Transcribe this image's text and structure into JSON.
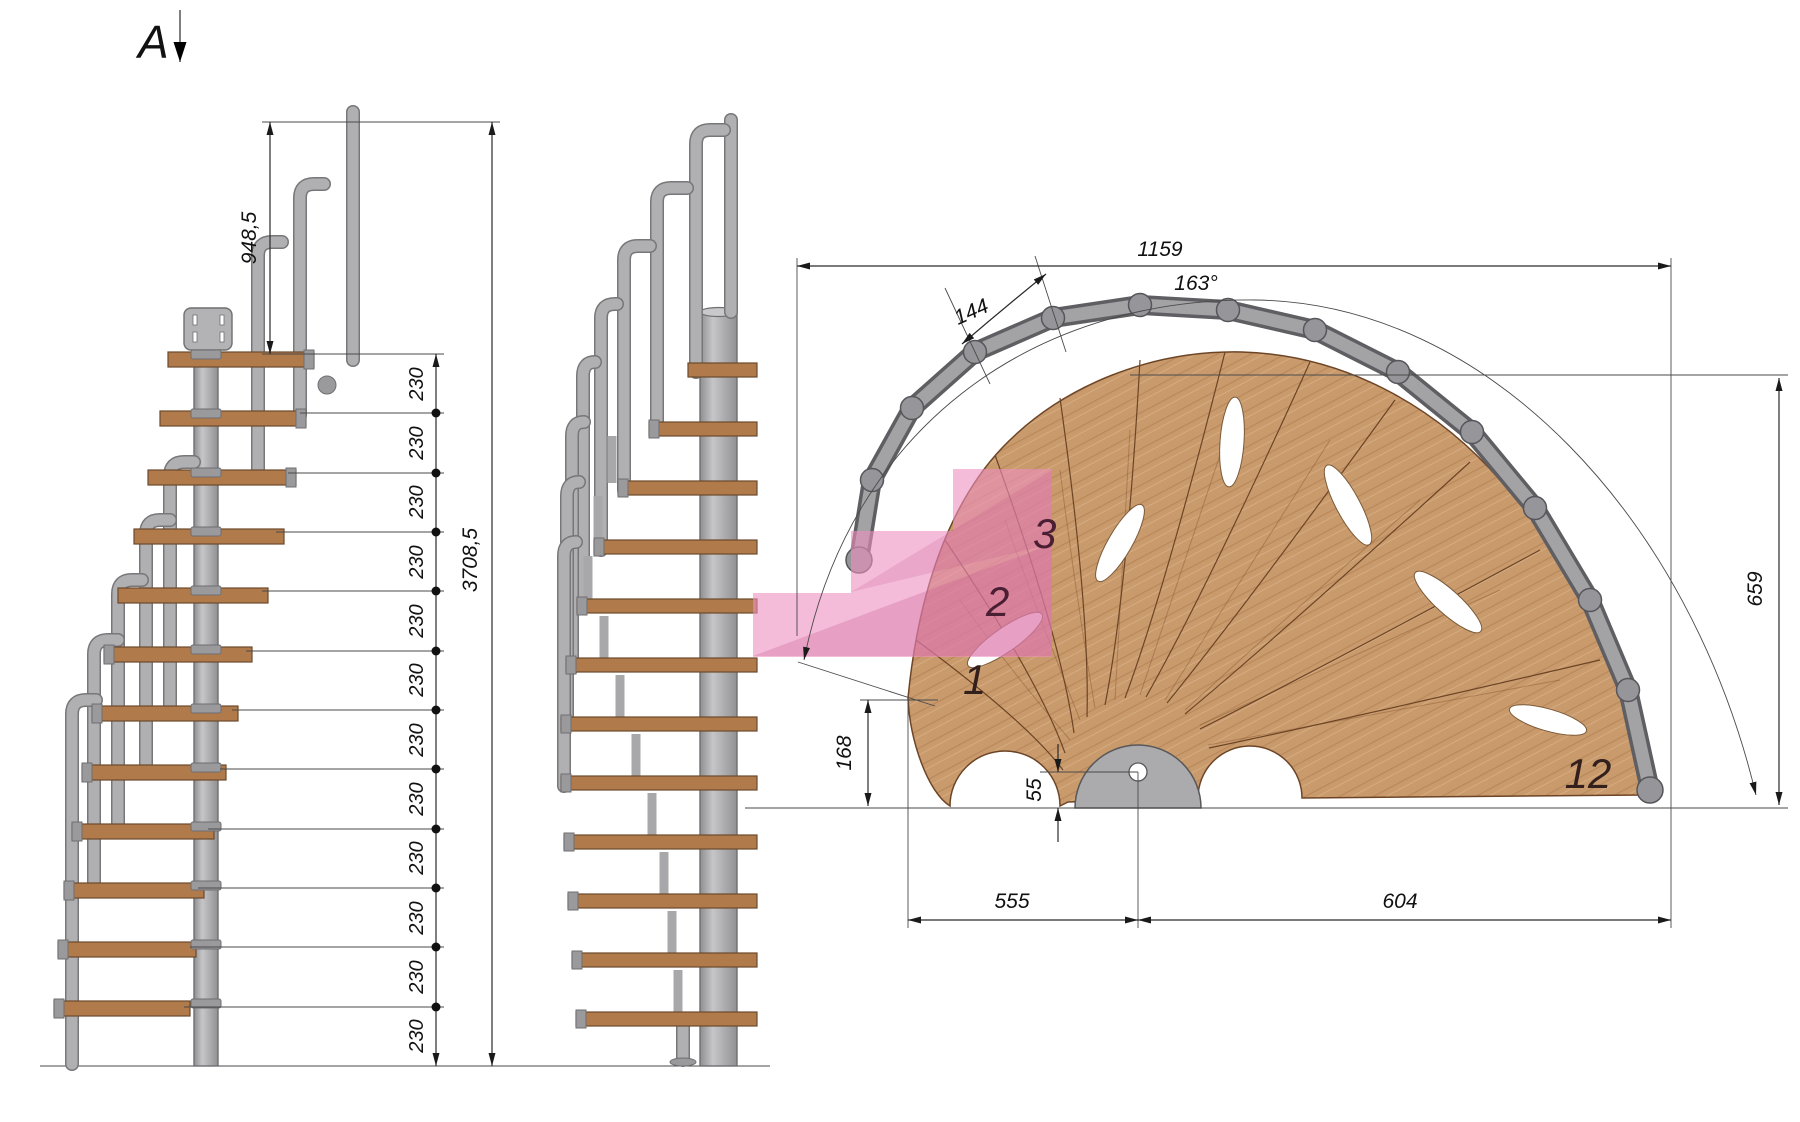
{
  "title": "Modular spiral staircase technical drawing",
  "section_marker": {
    "label": "A"
  },
  "elevation_dims": {
    "upper_post_height": "948,5",
    "total_height": "3708,5",
    "risers": [
      "230",
      "230",
      "230",
      "230",
      "230",
      "230",
      "230",
      "230",
      "230",
      "230",
      "230",
      "230"
    ]
  },
  "plan_dims": {
    "total_width": "1159",
    "tread_arc_width": "144",
    "rotation_angle": "163°",
    "height_right": "659",
    "tip_height": "168",
    "hub_offset": "55",
    "span_left": "555",
    "span_right": "604"
  },
  "step_labels": {
    "step1": "1",
    "step2": "2",
    "step3": "3",
    "step12": "12"
  },
  "colors": {
    "wood_top": "#c99a6c",
    "wood_side": "#b07a4b",
    "steel": "#b0b0b3",
    "steel_dark": "#6f6f72",
    "highlight_pink": "#ee8fc0",
    "dimension_line": "#2a2a2a"
  }
}
